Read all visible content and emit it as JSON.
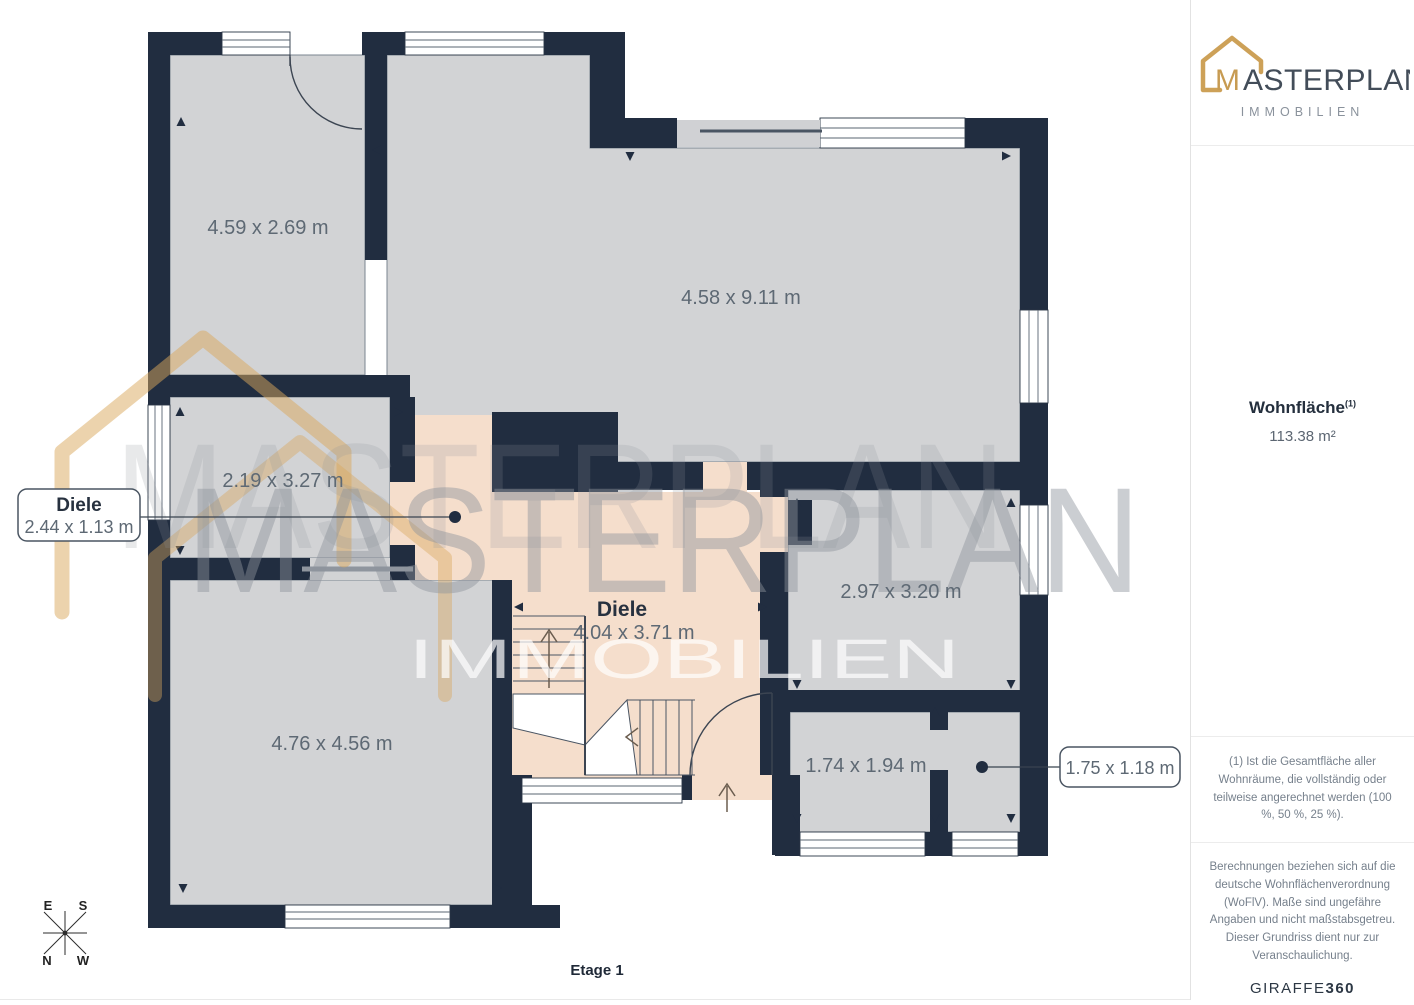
{
  "plan": {
    "floor_label": "Etage 1",
    "rooms": {
      "top_left_dims": "4.59 x 2.69 m",
      "living_dims": "4.58 x 9.11 m",
      "mid_left_dims": "2.19 x 3.27 m",
      "mid_right_dims": "2.97 x 3.20 m",
      "bottom_left_dims": "4.76 x 4.56 m",
      "bottom_right_dims": "1.74 x 1.94 m"
    },
    "diele": {
      "name": "Diele",
      "dims": "4.04 x 3.71 m"
    },
    "callout_left": {
      "title": "Diele",
      "dims": "2.44 x 1.13 m"
    },
    "callout_right": {
      "dims": "1.75 x 1.18 m"
    },
    "compass": {
      "e": "E",
      "s": "S",
      "n": "N",
      "w": "W"
    }
  },
  "watermark": {
    "brand": "MASTERPLAN",
    "sub": "IMMOBILIEN"
  },
  "sidebar": {
    "logo": {
      "brand_m": "M",
      "brand_rest": "ASTERPLAN",
      "subtitle": "IMMOBILIEN"
    },
    "area_label": "Wohnfläche",
    "area_sup": "(1)",
    "area_value": "113.38 m²",
    "footnote": "(1) Ist die Gesamtfläche aller Wohnräume, die vollständig oder teilweise angerechnet werden (100 %, 50 %, 25 %).",
    "disclaimer": "Berechnungen beziehen sich auf die deutsche Wohnflächenverordnung (WoFlV). Maße sind ungefähre Angaben und nicht maßstabsgetreu. Dieser Grundriss dient nur zur Veranschaulichung.",
    "brand_footer_regular": "GIRAFFE",
    "brand_footer_bold": "360"
  },
  "colors": {
    "wall": "#212D40",
    "floor": "#D2D3D5",
    "hall_floor": "#F5DECC",
    "watermark_gold": "#D9A75C",
    "label_text": "#5E6974"
  }
}
